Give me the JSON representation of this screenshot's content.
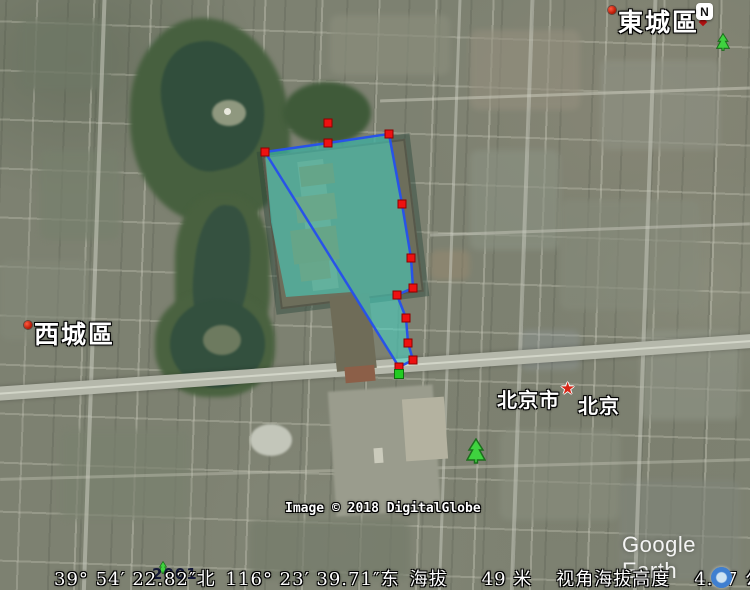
{
  "app_name": "Google Earth",
  "compass": {
    "north_label": "N"
  },
  "map_labels": {
    "district_top_right": "東城區",
    "district_left": "西城區",
    "city": "北京市",
    "capital": "北京",
    "year_label": "2001"
  },
  "watermarks": {
    "imagery_credit": "Image © 2018 DigitalGlobe",
    "logo": "Google Earth"
  },
  "status_bar": {
    "latitude": "39° 54′ 22.82″",
    "lat_hemisphere": "北",
    "longitude": "116° 23′ 39.71″",
    "lon_hemisphere": "东",
    "elevation_label": "海拔",
    "elevation_value": "49 米",
    "eye_altitude_label": "视角海拔高度",
    "eye_altitude_value": "4.47 公里"
  },
  "annotation": {
    "fill_color": "#40E0D0",
    "fill_opacity": 0.5,
    "stroke_color": "#2853E8",
    "stroke_width": 2.5,
    "marker_color": "#ee1111",
    "marker_edge": "#8f0000",
    "start_marker_color": "#22cc22",
    "start_marker_edge": "#0d6e0d",
    "path_points": [
      [
        265,
        152
      ],
      [
        328,
        143
      ],
      [
        389,
        134
      ],
      [
        402,
        204
      ],
      [
        411,
        258
      ],
      [
        413,
        288
      ],
      [
        397,
        295
      ],
      [
        406,
        318
      ],
      [
        408,
        343
      ],
      [
        413,
        360
      ],
      [
        399,
        367
      ]
    ],
    "fill_points": [
      [
        265,
        152
      ],
      [
        389,
        134
      ],
      [
        402,
        204
      ],
      [
        411,
        258
      ],
      [
        413,
        288
      ],
      [
        397,
        295
      ],
      [
        406,
        318
      ],
      [
        408,
        343
      ],
      [
        413,
        360
      ],
      [
        399,
        367
      ],
      [
        352,
        292
      ],
      [
        286,
        297
      ],
      [
        271,
        222
      ]
    ],
    "extra_markers": [
      [
        328,
        123
      ]
    ],
    "green_marker": [
      399,
      374
    ]
  }
}
